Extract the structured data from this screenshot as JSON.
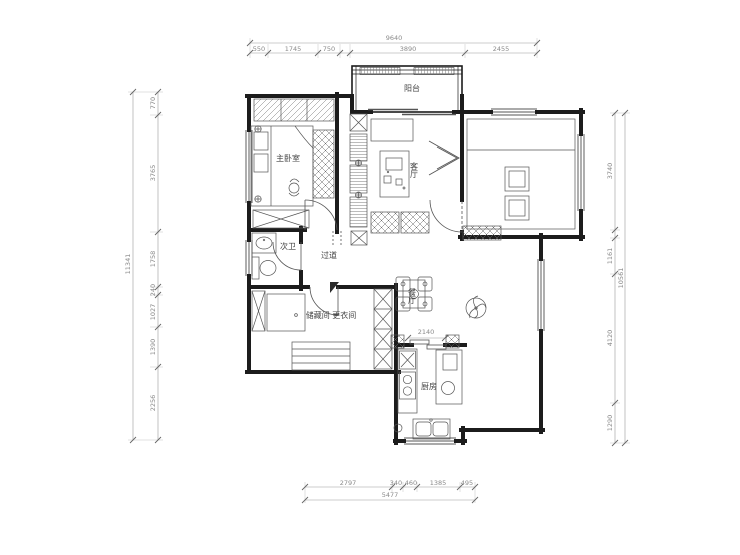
{
  "plan": {
    "rooms": {
      "master_bedroom": "主卧室",
      "balcony": "阳台",
      "living_room": "客厅",
      "second_bathroom": "次卫",
      "hallway": "过道",
      "storage_dressing": "储藏间 更衣间",
      "dining_room": "餐厅",
      "kitchen": "厨房"
    },
    "dimensions": {
      "top": {
        "total": "9640",
        "segments": [
          "550",
          "1745",
          "750",
          "3890",
          "2455"
        ]
      },
      "left": {
        "total": "11341",
        "segments": [
          "770",
          "3765",
          "1758",
          "240",
          "1027",
          "1390",
          "2256"
        ]
      },
      "right": {
        "total": "10561",
        "segments": [
          "3740",
          "1161",
          "4120",
          "1290"
        ]
      },
      "bottom": {
        "total": "5477",
        "segments": [
          "2797",
          "340",
          "460",
          "1385",
          "495"
        ]
      },
      "interior": {
        "kitchen_opening": "2140"
      }
    },
    "colors": {
      "wall": "#1c1c1c",
      "furniture_line": "#555555",
      "dimension_line": "#9a9a9a",
      "dimension_text": "#8a8a8a",
      "background": "#ffffff"
    }
  }
}
